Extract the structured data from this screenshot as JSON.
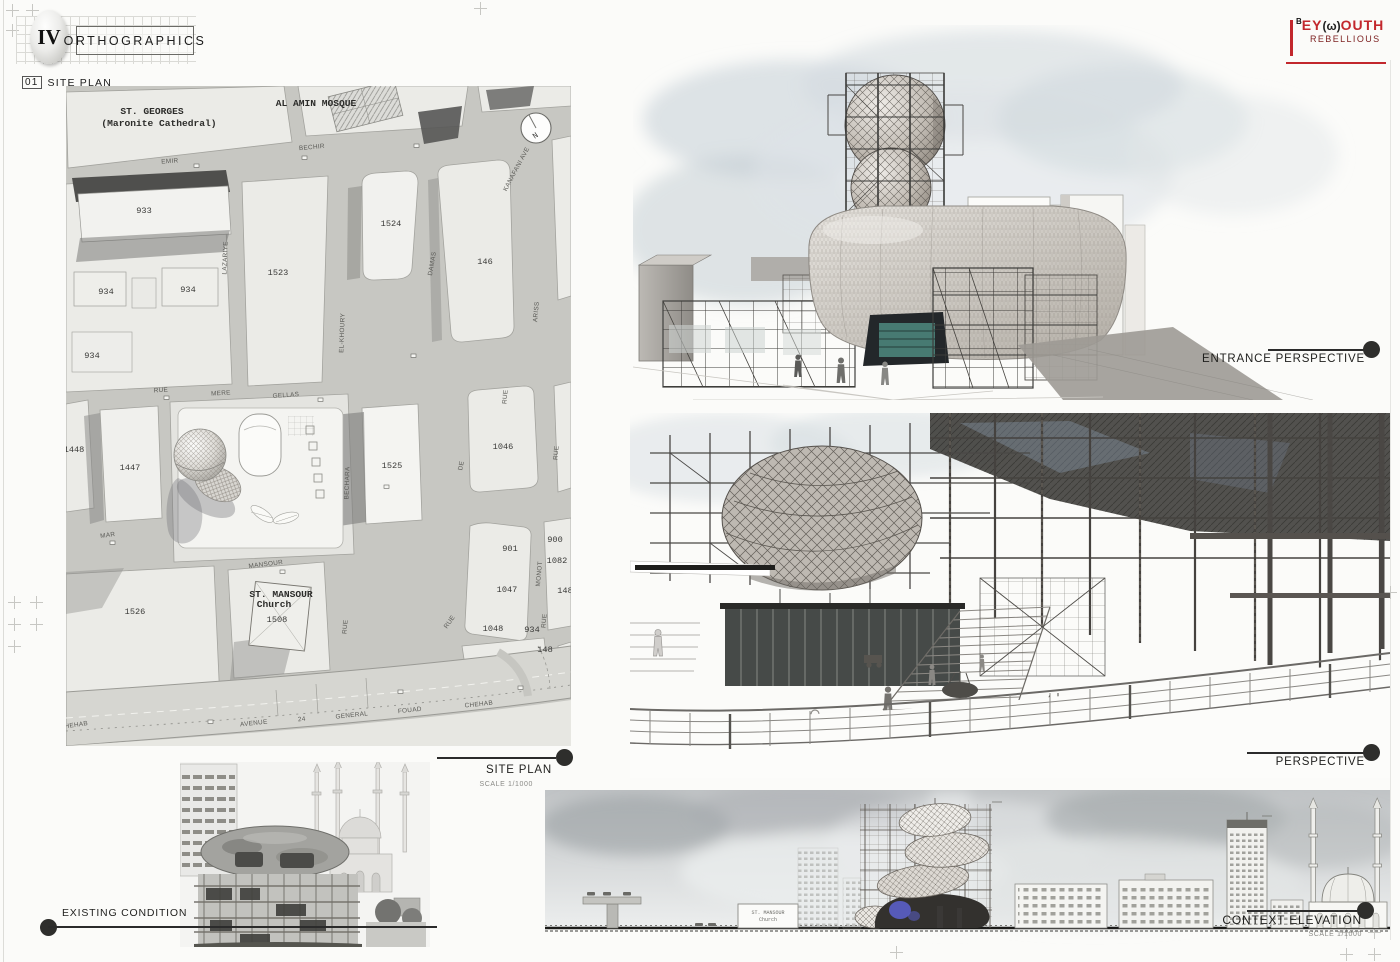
{
  "header": {
    "numeral": "IV",
    "title": "ORTHOGRAPHICS",
    "index": "01",
    "index_label": "SITE PLAN"
  },
  "logo": {
    "prefix": "B",
    "part1": "EY",
    "glyph": "(ω)",
    "part2": "OUTH",
    "line2": "REBELLIOUS",
    "accent": "#c2272d"
  },
  "site_plan": {
    "places": {
      "st_georges": "ST. GEORGES",
      "st_georges_sub": "(Maronite Cathedral)",
      "al_amin": "AL AMIN MOSQUE",
      "st_mansour": "ST. MANSOUR",
      "st_mansour_sub": "Church",
      "compass": "N"
    },
    "streets": {
      "emir": "EMIR",
      "bechir": "BECHIR",
      "lazariye": "LAZARIYE",
      "kanafani": "KANAFANI AVE",
      "damas": "DAMAS",
      "ariss": "ARISS",
      "el_khoury": "EL-KHOURY",
      "rue_a": "RUE",
      "mere": "MERE",
      "gellas": "GELLAS",
      "bechara": "BECHARA",
      "mar": "MAR",
      "mansour": "MANSOUR",
      "monot": "MONOT",
      "rue_b": "RUE",
      "de": "DE",
      "rue_c": "RUE",
      "rue_d": "RUE",
      "rue_e": "RUE",
      "rue_f": "RUE",
      "avenue": "AVENUE",
      "marker24": "24",
      "general": "GENERAL",
      "fouad": "FOUAD",
      "chehab": "CHEHAB",
      "chehab_w": "CHEHAB"
    },
    "parcels": {
      "p933": "933",
      "p934a": "934",
      "p934b": "934",
      "p934c": "934",
      "p934d": "934",
      "p1524": "1524",
      "p1523": "1523",
      "p146": "146",
      "p1448": "1448",
      "p1447": "1447",
      "p1525": "1525",
      "p1046": "1046",
      "p1526": "1526",
      "p1508": "1508",
      "p900": "900",
      "p901": "901",
      "p1082": "1082",
      "p1047": "1047",
      "p1048": "1048",
      "p148a": "148",
      "p148b": "148"
    },
    "caption": {
      "title": "SITE PLAN",
      "scale": "SCALE 1/1000"
    }
  },
  "entrance": {
    "caption": "ENTRANCE PERSPECTIVE"
  },
  "perspective": {
    "caption": "PERSPECTIVE"
  },
  "existing": {
    "caption": "EXISTING CONDITION"
  },
  "elevation": {
    "caption": "CONTEXT ELEVATION",
    "scale": "SCALE 1/1000",
    "church": "ST. MANSOUR",
    "church_sub": "Church"
  },
  "colors": {
    "accent_red": "#c2272d",
    "teal": "#3f6f68",
    "blue": "#5a5ec6",
    "paper": "#e9e9e5"
  }
}
